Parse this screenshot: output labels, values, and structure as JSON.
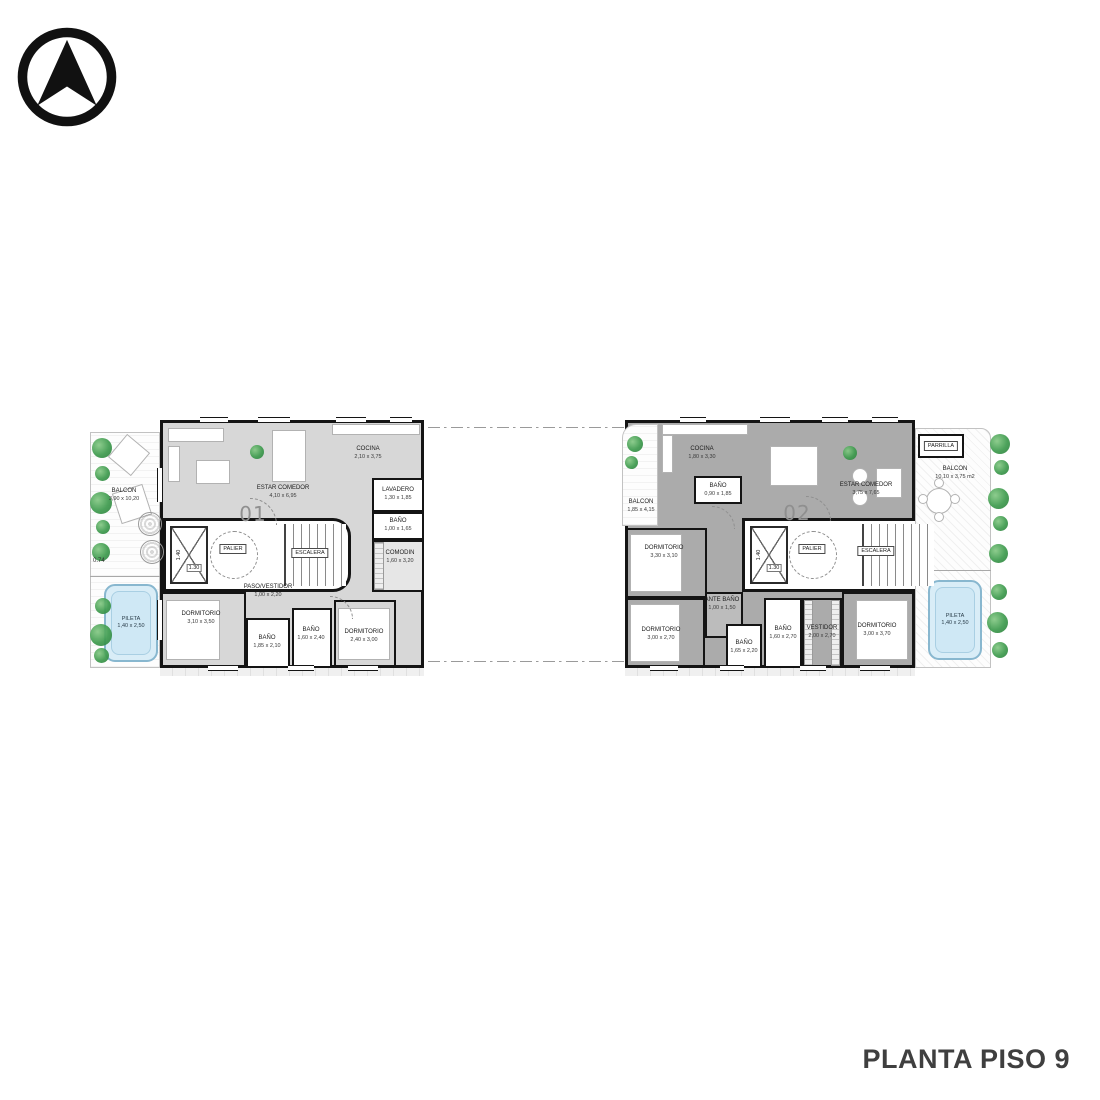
{
  "page": {
    "title": "PLANTA PISO 9"
  },
  "colors": {
    "plan1_fill": "#d7d7d7",
    "plan2_fill": "#ababab",
    "wall": "#141414",
    "pool_fill": "#d9edf7",
    "pool_border": "#88b7cf",
    "plant_green": "#3d9a4d",
    "title_color": "#3f3f3f"
  },
  "compass": {
    "icon": "north-arrow"
  },
  "plan1": {
    "unit": "01",
    "balcon": {
      "l": "BALCON",
      "d": "3,90 x 10,20"
    },
    "depth": "0.74",
    "pileta": {
      "l": "PILETA",
      "d": "1,40 x 2,50"
    },
    "estar": {
      "l": "ESTAR COMEDOR",
      "d": "4,10 x 6,95"
    },
    "cocina": {
      "l": "COCINA",
      "d": "2,10 x 3,75"
    },
    "lavadero": {
      "l": "LAVADERO",
      "d": "1,30 x 1,85"
    },
    "bano1": {
      "l": "BAÑO",
      "d": "1,00 x 1,65"
    },
    "comodin": {
      "l": "COMODIN",
      "d": "1,60 x 3,20"
    },
    "paso": {
      "l": "PASO/VESTIDOR",
      "d": "1,00 x 2,20"
    },
    "dorm1": {
      "l": "DORMITORIO",
      "d": "3,10 x 3,50"
    },
    "bano2": {
      "l": "BAÑO",
      "d": "1,85 x 2,10"
    },
    "bano3": {
      "l": "BAÑO",
      "d": "1,60 x 2,40"
    },
    "dorm2": {
      "l": "DORMITORIO",
      "d": "2,40 x 3,00"
    },
    "palier": "PALIER",
    "escalera": "ESCALERA",
    "lift_w": "1.40",
    "lift_d": "1.30"
  },
  "plan2": {
    "unit": "02",
    "balcon_left": {
      "l": "BALCON",
      "d": "1,85 x 4,15"
    },
    "balcon_right": {
      "l": "BALCON",
      "d": "10,10 x 3,75 m2"
    },
    "parrilla": "PARRILLA",
    "pileta": {
      "l": "PILETA",
      "d": "1,40 x 2,50"
    },
    "cocina": {
      "l": "COCINA",
      "d": "1,80 x 3,30"
    },
    "bano1": {
      "l": "BAÑO",
      "d": "0,90 x 1,85"
    },
    "estar": {
      "l": "ESTAR COMEDOR",
      "d": "3,75 x 7,65"
    },
    "dorm1": {
      "l": "DORMITORIO",
      "d": "3,30 x 3,10"
    },
    "dorm2": {
      "l": "DORMITORIO",
      "d": "3,00 x 2,70"
    },
    "antebano": {
      "l": "ANTE BAÑO",
      "d": "1,00 x 1,50"
    },
    "bano2": {
      "l": "BAÑO",
      "d": "1,65 x 2,20"
    },
    "bano3": {
      "l": "BAÑO",
      "d": "1,60 x 2,70"
    },
    "vestidor": {
      "l": "VESTIDOR",
      "d": "2,00 x 2,70"
    },
    "dorm3": {
      "l": "DORMITORIO",
      "d": "3,00 x 3,70"
    },
    "palier": "PALIER",
    "escalera": "ESCALERA",
    "lift_w": "1.40",
    "lift_d": "1.30"
  }
}
